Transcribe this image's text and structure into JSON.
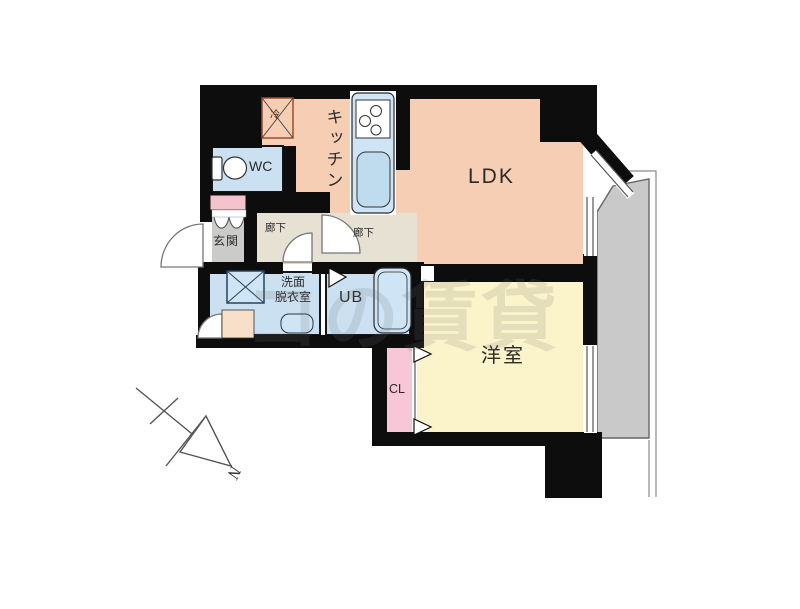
{
  "floor_plan": {
    "rooms": {
      "kitchen": "キッチン",
      "ldk": "LDK",
      "wc": "WC",
      "entrance": "玄関",
      "hallway1": "廊下",
      "hallway2": "廊下",
      "washroom": "洗面\n脱衣室",
      "unit_bath": "UB",
      "western_room": "洋室",
      "closet": "CL",
      "refrigerator": "冷"
    },
    "compass": {
      "north_label": "N"
    },
    "watermark": "コの賃貸",
    "colors": {
      "wall": "#0d0d0d",
      "ldk_floor": "#f6ceb4",
      "western_room_floor": "#fbf4cb",
      "wet_area_floor": "#cbe1f2",
      "closet": "#f7c6d7",
      "entrance_floor": "#cbcbc9",
      "hallway_floor": "#e7e1d3",
      "balcony": "#c9c9c9",
      "shoe_cabinet": "#f4c3cd",
      "storage_box": "#f8dfc8"
    }
  }
}
